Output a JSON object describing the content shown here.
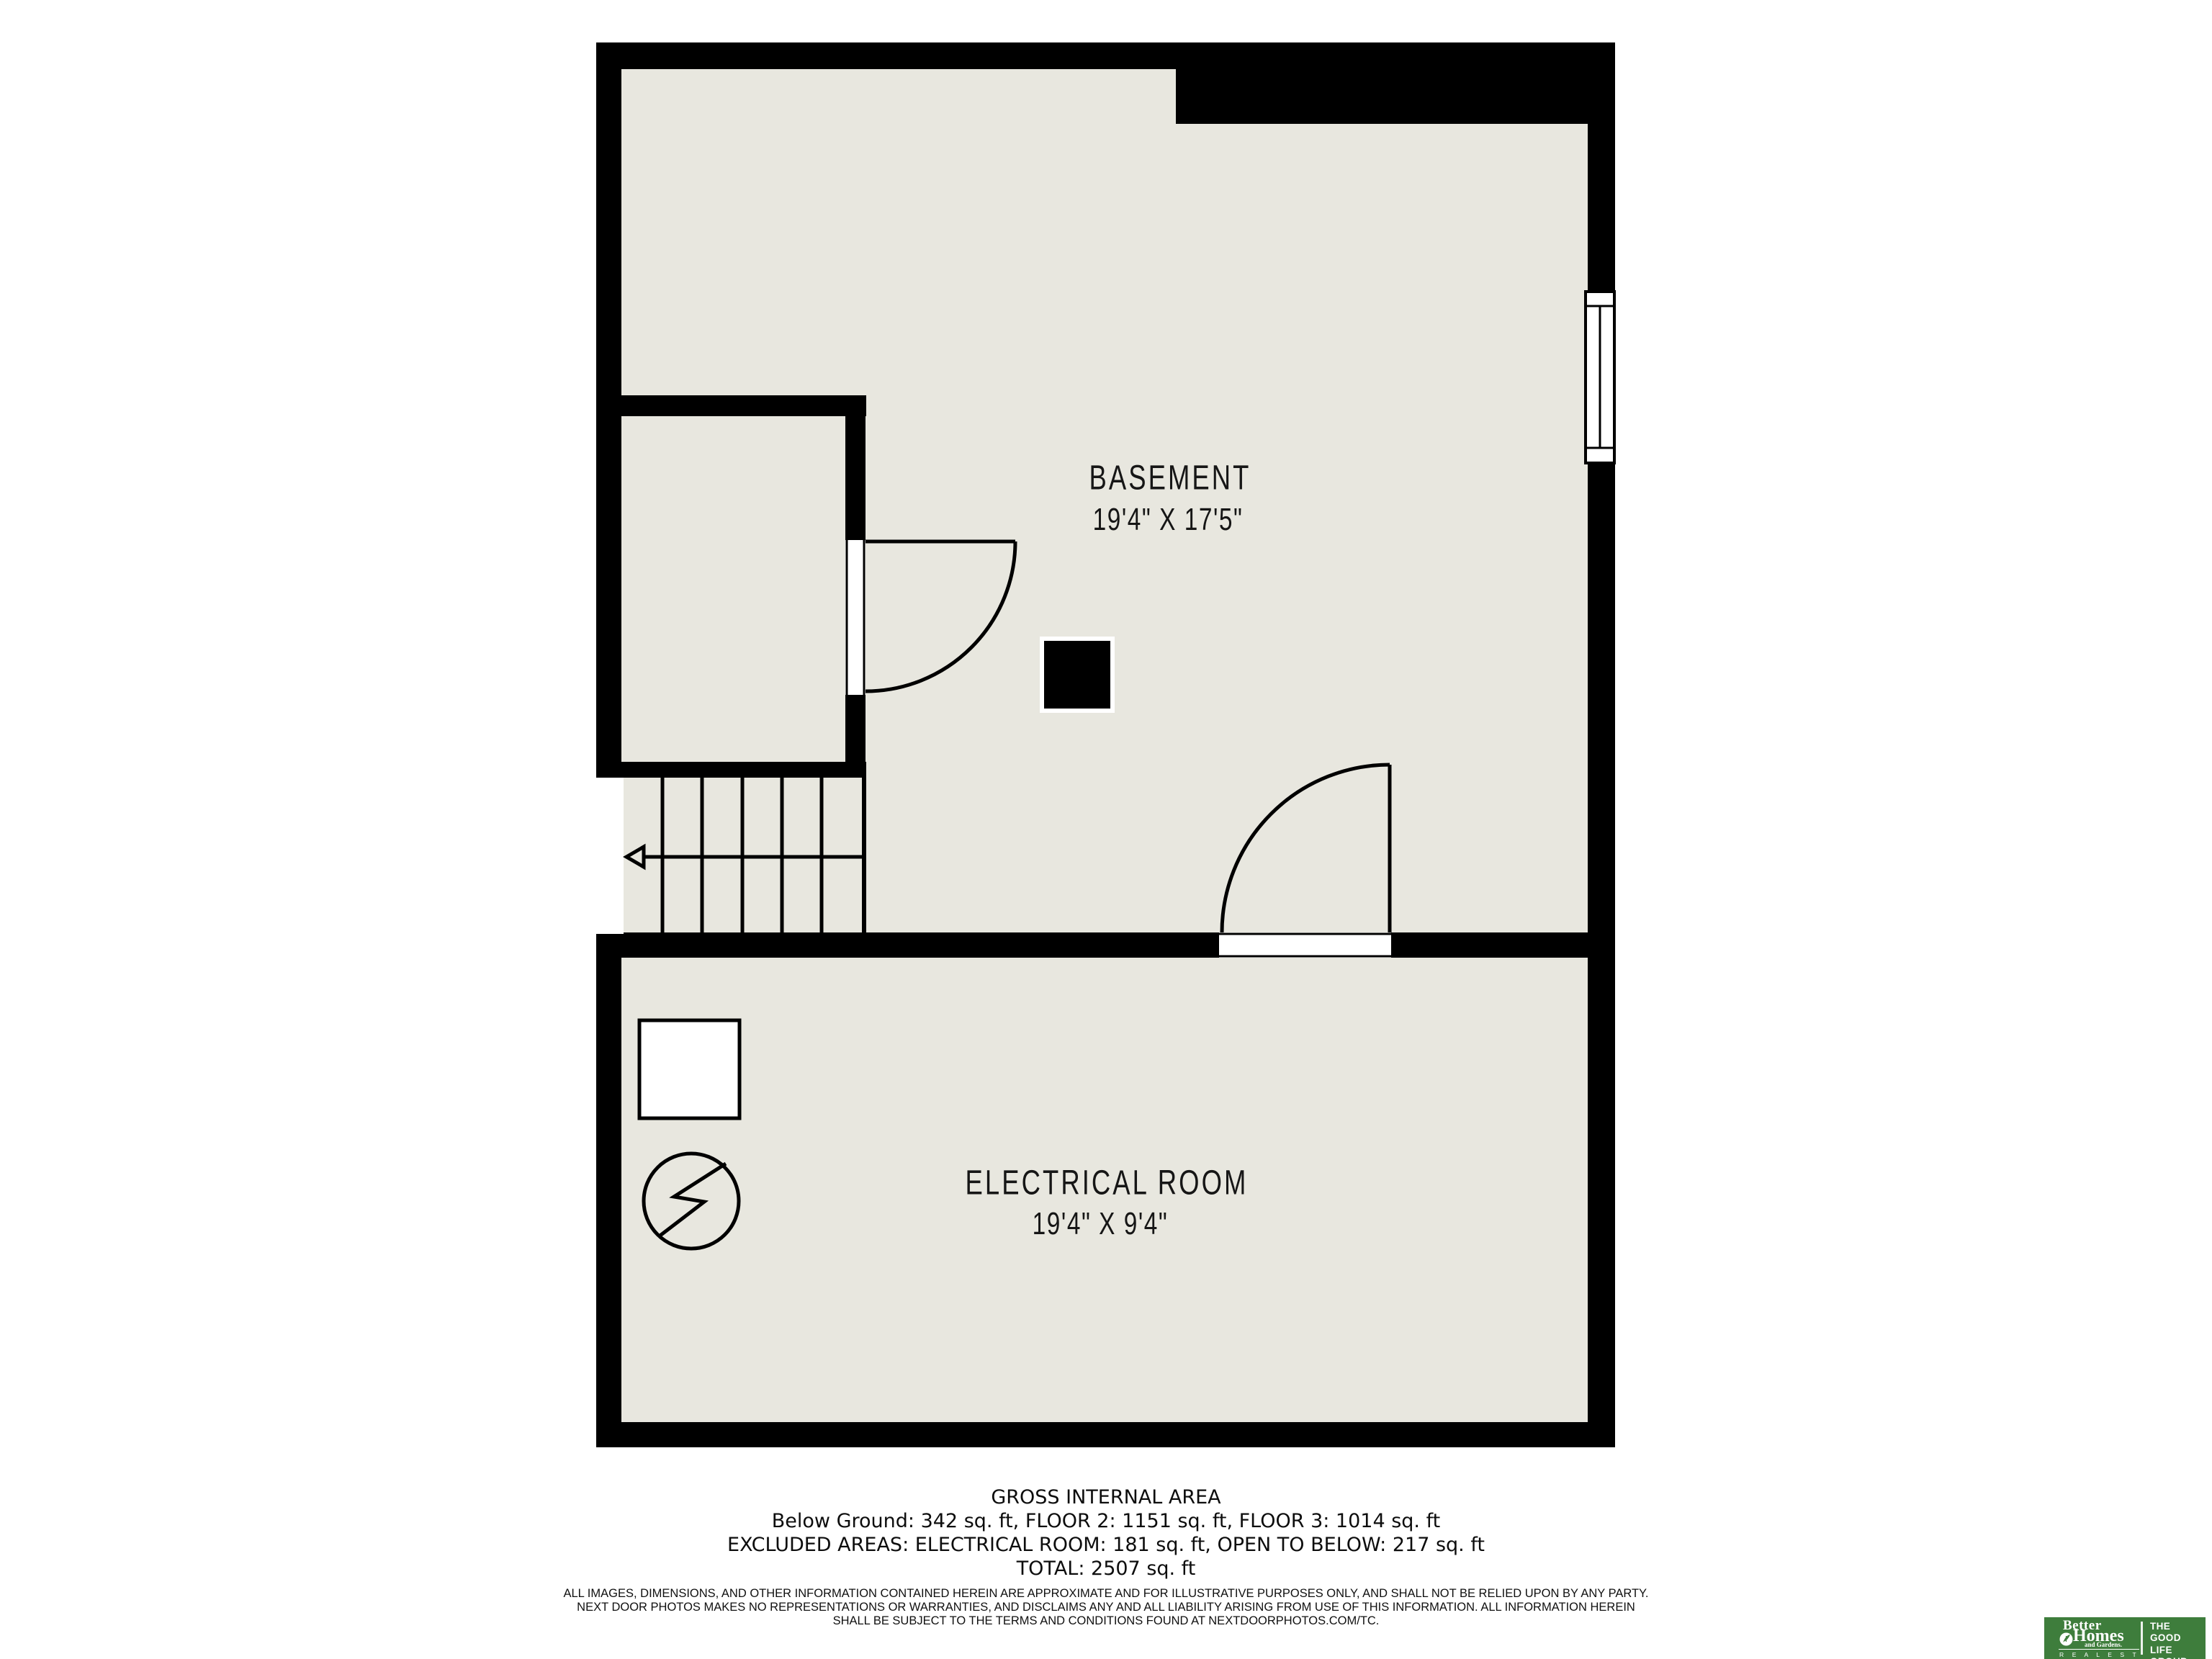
{
  "rooms": {
    "basement": {
      "label": "BASEMENT",
      "dims": "19'4\" X 17'5\""
    },
    "electrical": {
      "label": "ELECTRICAL ROOM",
      "dims": "19'4\" X 9'4\""
    }
  },
  "area_summary": {
    "title": "GROSS INTERNAL AREA",
    "floors": "Below Ground: 342 sq. ft, FLOOR 2: 1151 sq. ft, FLOOR 3: 1014 sq. ft",
    "excluded": "EXCLUDED AREAS: ELECTRICAL ROOM: 181 sq. ft, OPEN TO BELOW: 217 sq. ft",
    "total": "TOTAL: 2507 sq. ft"
  },
  "disclaimer": {
    "line1": "ALL IMAGES, DIMENSIONS, AND OTHER INFORMATION CONTAINED HEREIN ARE APPROXIMATE AND FOR ILLUSTRATIVE PURPOSES ONLY, AND SHALL NOT BE RELIED UPON BY ANY PARTY.",
    "line2": "NEXT DOOR PHOTOS MAKES NO REPRESENTATIONS OR WARRANTIES, AND DISCLAIMS ANY AND ALL LIABILITY ARISING FROM USE OF THIS INFORMATION. ALL INFORMATION HEREIN",
    "line3": "SHALL BE SUBJECT TO THE TERMS AND CONDITIONS FOUND AT NEXTDOORPHOTOS.COM/TC."
  },
  "logo": {
    "brand_top": "Better",
    "brand_mid": "Homes",
    "brand_sub": "and Gardens.",
    "brand_bottom": "R E A L   E S T A T E",
    "tagline_line1": "THE",
    "tagline_line2": "GOOD LIFE",
    "tagline_line3": "GROUP"
  },
  "colors": {
    "floor": "#e8e7df",
    "wall": "#000000",
    "page": "#ffffff",
    "logo_green": "#3e7d3c"
  }
}
